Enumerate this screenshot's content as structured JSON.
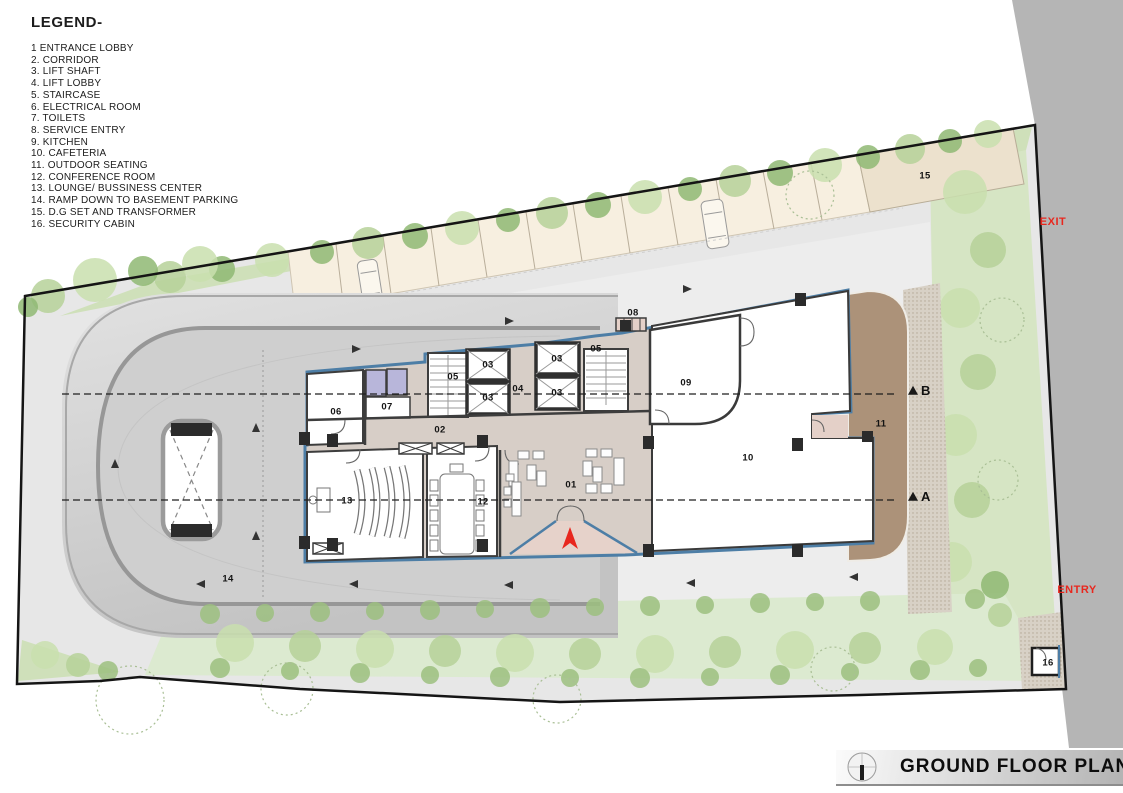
{
  "legend": {
    "title": "LEGEND-",
    "items": [
      {
        "num": "1",
        "label": "ENTRANCE LOBBY"
      },
      {
        "num": "2.",
        "label": "CORRIDOR"
      },
      {
        "num": "3.",
        "label": "LIFT SHAFT"
      },
      {
        "num": "4.",
        "label": "LIFT LOBBY"
      },
      {
        "num": "5.",
        "label": "STAIRCASE"
      },
      {
        "num": "6.",
        "label": "ELECTRICAL ROOM"
      },
      {
        "num": "7.",
        "label": "TOILETS"
      },
      {
        "num": "8.",
        "label": "SERVICE ENTRY"
      },
      {
        "num": "9.",
        "label": "KITCHEN"
      },
      {
        "num": "10.",
        "label": "CAFETERIA"
      },
      {
        "num": "11.",
        "label": "OUTDOOR SEATING"
      },
      {
        "num": "12.",
        "label": "CONFERENCE ROOM"
      },
      {
        "num": "13.",
        "label": "LOUNGE/ BUSSINESS CENTER"
      },
      {
        "num": "14.",
        "label": "RAMP DOWN TO BASEMENT PARKING"
      },
      {
        "num": "15.",
        "label": "D.G SET AND TRANSFORMER"
      },
      {
        "num": "16.",
        "label": "SECURITY CABIN"
      }
    ]
  },
  "plan": {
    "room_labels": [
      {
        "id": "01",
        "name": "entrance-lobby",
        "x": 571,
        "y": 485
      },
      {
        "id": "02",
        "name": "corridor",
        "x": 440,
        "y": 430
      },
      {
        "id": "03",
        "name": "lift-shaft-a",
        "x": 488,
        "y": 365
      },
      {
        "id": "03",
        "name": "lift-shaft-b",
        "x": 488,
        "y": 398
      },
      {
        "id": "03",
        "name": "lift-shaft-c",
        "x": 557,
        "y": 359
      },
      {
        "id": "03",
        "name": "lift-shaft-d",
        "x": 557,
        "y": 393
      },
      {
        "id": "04",
        "name": "lift-lobby",
        "x": 518,
        "y": 389
      },
      {
        "id": "05",
        "name": "staircase-a",
        "x": 453,
        "y": 377
      },
      {
        "id": "05",
        "name": "staircase-b",
        "x": 596,
        "y": 349
      },
      {
        "id": "06",
        "name": "electrical-room",
        "x": 336,
        "y": 412
      },
      {
        "id": "07",
        "name": "toilets",
        "x": 387,
        "y": 407
      },
      {
        "id": "08",
        "name": "service-entry",
        "x": 633,
        "y": 313
      },
      {
        "id": "09",
        "name": "kitchen",
        "x": 686,
        "y": 383
      },
      {
        "id": "10",
        "name": "cafeteria",
        "x": 748,
        "y": 458
      },
      {
        "id": "11",
        "name": "outdoor-seating",
        "x": 881,
        "y": 424
      },
      {
        "id": "12",
        "name": "conference-room",
        "x": 483,
        "y": 502
      },
      {
        "id": "13",
        "name": "lounge-business-center",
        "x": 347,
        "y": 501
      },
      {
        "id": "14",
        "name": "basement-ramp",
        "x": 228,
        "y": 579
      },
      {
        "id": "15",
        "name": "dg-set-transformer",
        "x": 925,
        "y": 176
      },
      {
        "id": "16",
        "name": "security-cabin",
        "x": 1048,
        "y": 663
      }
    ],
    "section_markers": [
      {
        "label": "B",
        "x": 908,
        "y": 391
      },
      {
        "label": "A",
        "x": 908,
        "y": 497
      }
    ],
    "site_labels": {
      "exit": "EXIT",
      "entry": "ENTRY"
    }
  },
  "titlebar": {
    "title": "GROUND FLOOR PLAN"
  },
  "colors": {
    "accent_red": "#e8271e",
    "wall_blue": "#4d7ea6",
    "outer_road": "#b5b5b5",
    "site_ground": "#e7e7e7",
    "landscape_green": "#cfe0ba",
    "wood_deck": "#b2987f"
  }
}
